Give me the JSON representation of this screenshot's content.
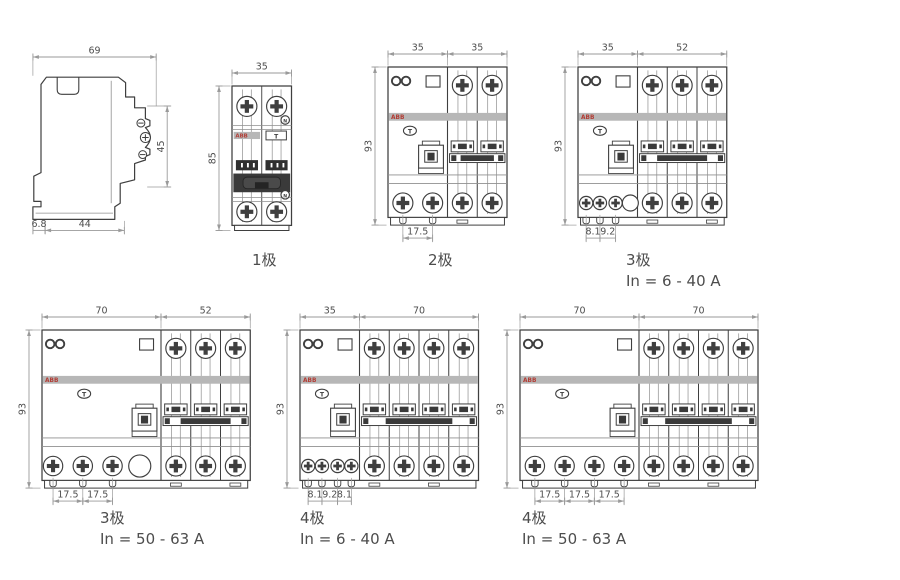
{
  "page": {
    "width": 900,
    "height": 580,
    "background": "#ffffff"
  },
  "colors": {
    "line": "#3f3f3f",
    "thin": "#8f8f8f",
    "dim_line": "#9a9a9a",
    "dim_text": "#4e4e4e",
    "band": "#b7b7b7",
    "band_text": "#b23b33",
    "dark": "#3a3a3a",
    "caption": "#4d4d4d"
  },
  "branding": {
    "logo_text": "ABB",
    "test_button": "T",
    "neutral_mark": "N"
  },
  "figures": [
    {
      "id": "side-view",
      "kind": "side",
      "caption_lines": [],
      "dims": {
        "top": "69",
        "right": "45",
        "bottom": [
          "6.8",
          "44"
        ]
      }
    },
    {
      "id": "pole-1",
      "kind": "single",
      "caption_lines": [
        "1极"
      ],
      "dims": {
        "top": [
          "35"
        ],
        "left": "85"
      }
    },
    {
      "id": "pole-2",
      "kind": "combo",
      "caption_lines": [
        "2极"
      ],
      "rcd_modules": 2,
      "mcb_modules": 2,
      "dims": {
        "top": [
          "35",
          "35"
        ],
        "left": "93",
        "bottom": [
          "17.5"
        ]
      }
    },
    {
      "id": "pole-3-40",
      "kind": "combo",
      "caption_lines": [
        "3极",
        "In = 6 - 40 A"
      ],
      "rcd_modules": 2,
      "mcb_modules": 3,
      "dims": {
        "top": [
          "35",
          "52"
        ],
        "left": "93",
        "bottom": [
          "8.1",
          "9.2"
        ]
      }
    },
    {
      "id": "pole-3-63",
      "kind": "combo",
      "caption_lines": [
        "3极",
        "In = 50 - 63 A"
      ],
      "rcd_modules": 4,
      "mcb_modules": 3,
      "dims": {
        "top": [
          "70",
          "52"
        ],
        "left": "93",
        "bottom": [
          "17.5",
          "17.5"
        ]
      }
    },
    {
      "id": "pole-4-40",
      "kind": "combo",
      "caption_lines": [
        "4极",
        "In = 6 - 40 A"
      ],
      "rcd_modules": 2,
      "mcb_modules": 4,
      "dims": {
        "top": [
          "35",
          "70"
        ],
        "left": "93",
        "bottom": [
          "8.1",
          "9.2",
          "8.1"
        ]
      }
    },
    {
      "id": "pole-4-63",
      "kind": "combo",
      "caption_lines": [
        "4极",
        "In = 50 - 63 A"
      ],
      "rcd_modules": 4,
      "mcb_modules": 4,
      "dims": {
        "top": [
          "70",
          "70"
        ],
        "left": "93",
        "bottom": [
          "17.5",
          "17.5",
          "17.5"
        ]
      }
    }
  ]
}
